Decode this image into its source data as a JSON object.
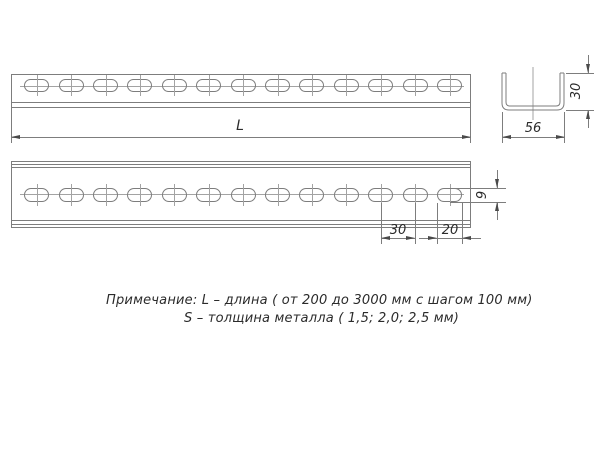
{
  "dimensions": {
    "length_label": "L",
    "section_width": "56",
    "section_height": "30",
    "slot_pitch": "30",
    "slot_length": "20",
    "slot_height": "9"
  },
  "drawing": {
    "slot_count": 13
  },
  "note": {
    "line1": "Примечание: L – длина ( от 200 до 3000 мм с шагом 100 мм)",
    "line2": "S – толщина металла ( 1,5; 2,0; 2,5 мм)"
  },
  "colors": {
    "outline": "#7d7d7d",
    "centerline": "#a3a3a3",
    "dimension": "#4a4a4a",
    "text": "#2b2b2b"
  }
}
